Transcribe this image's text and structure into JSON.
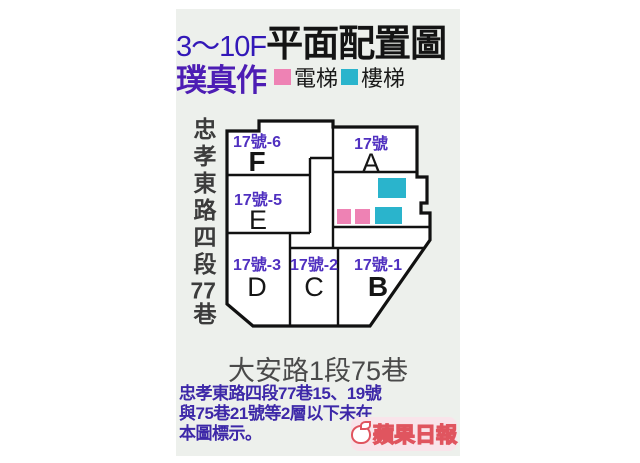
{
  "colors": {
    "content_bg": "#edf0ec",
    "title_range_purple": "#3218b8",
    "title_black": "#141414",
    "brand_purple": "#4d1db4",
    "unit_number_purple": "#5030c0",
    "note_purple": "#3d28a8",
    "elevator_pink": "#ee82b4",
    "stairs_cyan": "#2ab4cc",
    "wall_black": "#111111",
    "street_gray": "#4a4a4a",
    "logo_red": "#e0555f"
  },
  "header": {
    "floor_range": "3～10F",
    "title": "平面配置圖",
    "brand": "璞真作",
    "legend": [
      {
        "name": "elevator",
        "label": "電梯",
        "color": "#ee82b4"
      },
      {
        "name": "stairs",
        "label": "樓梯",
        "color": "#2ab4cc"
      }
    ]
  },
  "plan": {
    "street_left": {
      "part1": "忠孝東路四段",
      "part2": "77",
      "part3": "巷"
    },
    "street_bottom": "大安路1段75巷",
    "units": [
      {
        "letter": "F",
        "number": "17號-6"
      },
      {
        "letter": "A",
        "number": "17號"
      },
      {
        "letter": "E",
        "number": "17號-5"
      },
      {
        "letter": "D",
        "number": "17號-3"
      },
      {
        "letter": "C",
        "number": "17號-2"
      },
      {
        "letter": "B",
        "number": "17號-1"
      }
    ]
  },
  "footnote": {
    "line1": "忠孝東路四段77巷15、19號",
    "line2": "與75巷21號等2層以下未在",
    "line3": "本圖標示。"
  },
  "logo": {
    "text": "蘋果日報"
  }
}
